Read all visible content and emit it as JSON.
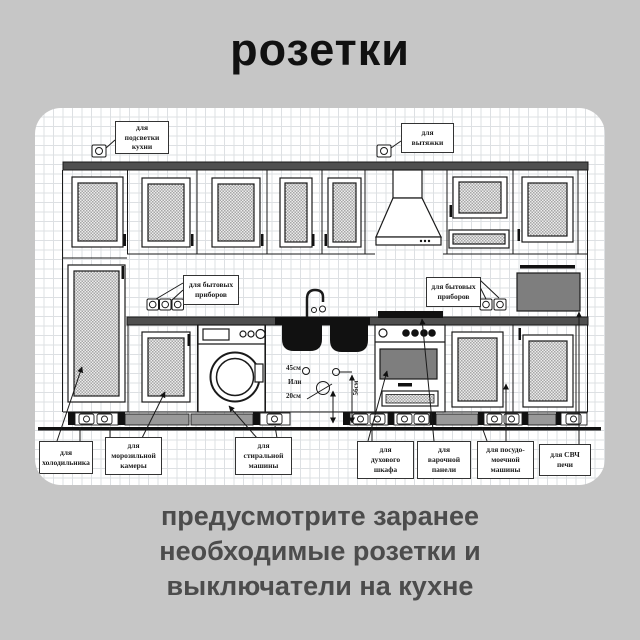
{
  "page": {
    "title": "розетки",
    "caption_lines": [
      "предусмотрите заранее",
      "необходимые розетки и",
      "выключатели на кухне"
    ]
  },
  "diagram": {
    "callouts": {
      "backlight": "для\nподсветки\nкухни",
      "hood": "для\nвытяжки",
      "appliances_left": "для бытовых\nприборов",
      "appliances_right": "для бытовых\nприборов",
      "fridge": "для\nхолодильника",
      "freezer": "для\nморозильной\nкамеры",
      "washer": "для\nстиральной\nмашины",
      "oven": "для\nдухового\nшкафа",
      "hob": "для\nварочной\nпанели",
      "dishwasher": "для посудо-\nмоечной\nмашины",
      "microwave": "для СВЧ\nпечи"
    },
    "dimensions": {
      "d45": "45см",
      "or": "Или",
      "d20": "20см",
      "d56": "56см"
    }
  },
  "colors": {
    "page_bg": "#c6c6c6",
    "title_text": "#111111",
    "caption_text": "#4c4c4c",
    "diagram_line": "#1a1a1a",
    "counter_gray": "#4f4f4f",
    "appliance_gray": "#7e7e7e"
  }
}
